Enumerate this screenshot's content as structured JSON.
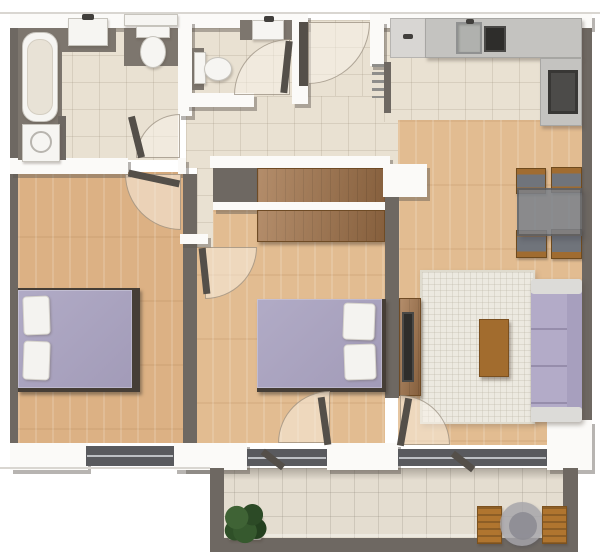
{
  "plan": {
    "kind": "apartment-floor-plan-top-view",
    "width": 600,
    "height": 560
  },
  "palette": {
    "wall_dark": "#6e6862",
    "wall_white": "#fbfaf8",
    "tile": "#e9e1d2",
    "tile_balcony": "#e4ddd0",
    "wood": "#e2bc91",
    "wood_dark": "#dcb184",
    "furniture_wood": "#a3744a",
    "lavender": "#b1abc6",
    "lavender_sofa": "#b3abc8",
    "white_fixture": "#f6f5f2",
    "counter": "#c4c3c0",
    "counter_light": "#d8d6d3",
    "appliance_dark": "#2e2d2b",
    "appliance_mid": "#4c4b49",
    "window": "#595a5e",
    "rug": "#ece9e0",
    "glass": "#7b828c",
    "plant": "#31502b",
    "chair_balcony": "#b0752f"
  },
  "rooms": [
    "bathroom",
    "wc",
    "entry-hall",
    "corridor",
    "kitchen",
    "living-dining-room",
    "bedroom-1",
    "bedroom-2",
    "balcony"
  ],
  "elements": [
    {
      "n": "top-hairline",
      "c": "hairline",
      "b": [
        0,
        12,
        600,
        2
      ]
    },
    {
      "n": "bathroom-floor",
      "c": "tile",
      "b": [
        18,
        28,
        160,
        132
      ]
    },
    {
      "n": "wc-floor",
      "c": "tile",
      "b": [
        192,
        28,
        100,
        68
      ]
    },
    {
      "n": "entry-floor",
      "c": "tile",
      "b": [
        308,
        20,
        76,
        86
      ]
    },
    {
      "n": "corridor-floor",
      "c": "tile",
      "b": [
        186,
        96,
        212,
        72
      ]
    },
    {
      "n": "kitchen-floor",
      "c": "tile",
      "b": [
        384,
        28,
        198,
        94
      ]
    },
    {
      "n": "living-room-floor",
      "c": "wood",
      "b": [
        398,
        120,
        184,
        325
      ]
    },
    {
      "n": "bedroom2-niche-floor",
      "c": "wood",
      "b": [
        213,
        164,
        172,
        46
      ]
    },
    {
      "n": "bedroom2-floor",
      "c": "wood",
      "b": [
        195,
        210,
        190,
        233
      ]
    },
    {
      "n": "corridor-stub-floor",
      "c": "tile",
      "b": [
        197,
        168,
        16,
        79
      ]
    },
    {
      "n": "bedroom1-floor",
      "c": "wood wood-dark",
      "b": [
        18,
        172,
        165,
        271
      ]
    },
    {
      "n": "balcony-floor",
      "c": "tileb",
      "b": [
        210,
        468,
        368,
        80
      ]
    },
    {
      "n": "balcony-wall-shadow",
      "c": "shade",
      "b": [
        224,
        468,
        339,
        12
      ]
    },
    {
      "n": "top-wall-left",
      "c": "wallw",
      "b": [
        10,
        14,
        298,
        14
      ]
    },
    {
      "n": "top-wall-right",
      "c": "wallw",
      "b": [
        370,
        14,
        222,
        14
      ]
    },
    {
      "n": "left-outer-wall",
      "c": "walld",
      "b": [
        10,
        28,
        8,
        415
      ]
    },
    {
      "n": "right-outer-wall",
      "c": "walld",
      "b": [
        582,
        28,
        10,
        392
      ]
    },
    {
      "n": "bathroom-right-wall",
      "c": "wallw",
      "b": [
        178,
        20,
        14,
        96
      ]
    },
    {
      "n": "bathroom-bottom-wall",
      "c": "wallw",
      "b": [
        10,
        158,
        118,
        16
      ]
    },
    {
      "n": "bathroom-bottom-wall-cap",
      "c": "wallw",
      "b": [
        178,
        158,
        8,
        16
      ]
    },
    {
      "n": "wc-bottom-wall",
      "c": "wallw",
      "b": [
        186,
        93,
        68,
        14
      ]
    },
    {
      "n": "wc-right-wall",
      "c": "wallw",
      "b": [
        292,
        20,
        16,
        84
      ]
    },
    {
      "n": "entry-right-wall",
      "c": "wallw",
      "b": [
        370,
        20,
        14,
        46
      ]
    },
    {
      "n": "kitchen-west-wall",
      "c": "walld",
      "b": [
        384,
        62,
        7,
        51
      ]
    },
    {
      "n": "wardrobe-niche-top-wall",
      "c": "wallw",
      "b": [
        210,
        156,
        180,
        12
      ]
    },
    {
      "n": "wardrobe-niche-left-block",
      "c": "walld",
      "b": [
        213,
        168,
        44,
        40
      ]
    },
    {
      "n": "hall-wardrobe",
      "c": "wood-item",
      "b": [
        257,
        168,
        130,
        36
      ]
    },
    {
      "n": "wardrobe-niche-mid-wall",
      "c": "wallw",
      "b": [
        213,
        202,
        177,
        8
      ]
    },
    {
      "n": "bedroom2-wardrobe",
      "c": "wood-item",
      "b": [
        257,
        210,
        128,
        32
      ]
    },
    {
      "n": "bedroom-divider-wall",
      "c": "walld",
      "b": [
        183,
        174,
        14,
        269
      ]
    },
    {
      "n": "bedroom-divider-cap",
      "c": "wallw",
      "b": [
        180,
        234,
        28,
        10
      ]
    },
    {
      "n": "living-wall-corner",
      "c": "wallw",
      "b": [
        383,
        164,
        44,
        33
      ]
    },
    {
      "n": "bedroom2-living-wall",
      "c": "walld",
      "b": [
        385,
        197,
        14,
        201
      ]
    },
    {
      "n": "bedroom1-bottom-wall-left",
      "c": "wallw",
      "b": [
        10,
        443,
        78,
        27
      ]
    },
    {
      "n": "bedroom1-window",
      "c": "window",
      "b": [
        86,
        446,
        88,
        20
      ]
    },
    {
      "n": "bedroom1-bottom-wall-right",
      "c": "wallw",
      "b": [
        174,
        443,
        36,
        27
      ]
    },
    {
      "n": "bedroom2-bottom-wall-left",
      "c": "wallw",
      "b": [
        183,
        443,
        64,
        27
      ]
    },
    {
      "n": "bedroom2-balcony-door-glass",
      "c": "window",
      "b": [
        247,
        449,
        80,
        17
      ]
    },
    {
      "n": "bedroom2-bottom-wall-right",
      "c": "wallw",
      "b": [
        327,
        443,
        71,
        27
      ]
    },
    {
      "n": "living-balcony-window",
      "c": "window",
      "b": [
        398,
        449,
        149,
        17
      ]
    },
    {
      "n": "living-bottom-wall",
      "c": "wallw",
      "b": [
        547,
        420,
        45,
        50
      ]
    },
    {
      "n": "left-hairline",
      "c": "hairline",
      "b": [
        0,
        467,
        210,
        2
      ]
    },
    {
      "n": "bathtub-deck",
      "c": "wallm",
      "b": [
        18,
        28,
        44,
        132
      ]
    },
    {
      "n": "bathtub",
      "c": "white-box",
      "b": [
        22,
        32,
        36,
        90
      ],
      "rad": "14px"
    },
    {
      "n": "bathtub-inner",
      "c": "inner-beige",
      "b": [
        27,
        39,
        26,
        76
      ],
      "rad": "12px"
    },
    {
      "n": "washer-nook-wall",
      "c": "walld",
      "b": [
        58,
        116,
        8,
        44
      ]
    },
    {
      "n": "washing-machine",
      "c": "white-box",
      "b": [
        22,
        124,
        38,
        38
      ]
    },
    {
      "n": "washing-machine-door",
      "c": "ring",
      "b": [
        30,
        131,
        22,
        22
      ],
      "rad": "50%"
    },
    {
      "n": "bath-sink-backsplash",
      "c": "wallm",
      "b": [
        62,
        28,
        54,
        24
      ]
    },
    {
      "n": "bath-sink",
      "c": "white-box",
      "b": [
        68,
        18,
        40,
        28
      ]
    },
    {
      "n": "bath-faucet",
      "c": "dark-dot",
      "b": [
        82,
        14,
        12,
        6
      ]
    },
    {
      "n": "bath-toilet-backdrop",
      "c": "wallm",
      "b": [
        124,
        28,
        54,
        38
      ]
    },
    {
      "n": "bath-toilet-shelf",
      "c": "white-box",
      "b": [
        124,
        14,
        54,
        12
      ]
    },
    {
      "n": "bath-toilet-cistern",
      "c": "white-box",
      "b": [
        136,
        26,
        34,
        12
      ]
    },
    {
      "n": "bath-toilet-bowl",
      "c": "white-box",
      "b": [
        140,
        36,
        26,
        32
      ],
      "rad": "50%"
    },
    {
      "n": "bathroom-door-arc",
      "c": "arc",
      "b": [
        136,
        114,
        44,
        44
      ],
      "rad": "100% 0 0 0"
    },
    {
      "n": "bathroom-door-leaf",
      "c": "leaf",
      "b": [
        133,
        116,
        7,
        42
      ],
      "r": -14
    },
    {
      "n": "wc-toilet-backdrop",
      "c": "wallm",
      "b": [
        192,
        48,
        12,
        42
      ]
    },
    {
      "n": "wc-toilet-cistern",
      "c": "white-box",
      "b": [
        194,
        52,
        12,
        32
      ]
    },
    {
      "n": "wc-toilet-bowl",
      "c": "white-box",
      "b": [
        204,
        57,
        28,
        24
      ],
      "rad": "50%"
    },
    {
      "n": "wc-sink-backsplash",
      "c": "wallm",
      "b": [
        240,
        20,
        52,
        20
      ]
    },
    {
      "n": "wc-sink",
      "c": "white-box",
      "b": [
        252,
        20,
        32,
        20
      ]
    },
    {
      "n": "wc-faucet",
      "c": "dark-dot",
      "b": [
        264,
        16,
        10,
        6
      ]
    },
    {
      "n": "wc-door-arc",
      "c": "arc",
      "b": [
        234,
        39,
        56,
        56
      ],
      "rad": "100% 0 0 0"
    },
    {
      "n": "wc-door-leaf",
      "c": "leaf",
      "b": [
        283,
        41,
        7,
        52
      ],
      "r": 6
    },
    {
      "n": "front-door-arc",
      "c": "arc",
      "b": [
        308,
        22,
        62,
        62
      ],
      "rad": "0 0 100% 0"
    },
    {
      "n": "front-door-leaf",
      "c": "leaf",
      "b": [
        299,
        22,
        9,
        64
      ]
    },
    {
      "n": "entry-coat-rack",
      "c": "rack",
      "b": [
        372,
        64,
        12,
        34
      ]
    },
    {
      "n": "kitchen-cabinet",
      "c": "counter-light",
      "b": [
        390,
        18,
        36,
        40
      ]
    },
    {
      "n": "kitchen-cabinet-handle",
      "c": "dark-dot",
      "b": [
        403,
        34,
        10,
        5
      ]
    },
    {
      "n": "kitchen-counter-top",
      "c": "counter",
      "b": [
        425,
        18,
        157,
        40
      ]
    },
    {
      "n": "kitchen-sink",
      "c": "sink-metal",
      "b": [
        456,
        22,
        26,
        32
      ]
    },
    {
      "n": "kitchen-faucet",
      "c": "dark-dot",
      "b": [
        466,
        19,
        8,
        5
      ]
    },
    {
      "n": "kitchen-cooktop",
      "c": "dark-box",
      "b": [
        484,
        26,
        22,
        26
      ]
    },
    {
      "n": "kitchen-counter-right",
      "c": "counter",
      "b": [
        540,
        58,
        42,
        68
      ]
    },
    {
      "n": "kitchen-oven",
      "c": "oven",
      "b": [
        548,
        70,
        30,
        44
      ]
    },
    {
      "n": "dining-chair-top-left",
      "c": "chair",
      "b": [
        516,
        168,
        30,
        26
      ]
    },
    {
      "n": "dining-chair-top-right",
      "c": "chair",
      "b": [
        551,
        167,
        31,
        26
      ]
    },
    {
      "n": "dining-chair-bottom-left",
      "c": "chair",
      "b": [
        516,
        230,
        31,
        28
      ]
    },
    {
      "n": "dining-chair-bottom-right",
      "c": "chair",
      "b": [
        551,
        229,
        31,
        30
      ]
    },
    {
      "n": "dining-table",
      "c": "glass",
      "b": [
        517,
        188,
        65,
        48
      ]
    },
    {
      "n": "living-rug",
      "c": "rug",
      "b": [
        420,
        270,
        115,
        154
      ]
    },
    {
      "n": "tv-unit",
      "c": "wood-item",
      "b": [
        399,
        298,
        22,
        98
      ]
    },
    {
      "n": "tv",
      "c": "dark-box",
      "b": [
        402,
        312,
        12,
        70
      ]
    },
    {
      "n": "coffee-table",
      "c": "wood-item2",
      "b": [
        479,
        319,
        30,
        58
      ]
    },
    {
      "n": "sofa-base",
      "c": "sofa-base",
      "b": [
        531,
        279,
        51,
        143
      ]
    },
    {
      "n": "sofa-seat",
      "c": "sofa-seat",
      "b": [
        531,
        293,
        38,
        114
      ]
    },
    {
      "n": "sofa-back",
      "c": "sofa-back",
      "b": [
        567,
        287,
        15,
        128
      ]
    },
    {
      "n": "sofa-armrest-top",
      "c": "sofa-arm",
      "b": [
        531,
        279,
        51,
        15
      ]
    },
    {
      "n": "sofa-armrest-bottom",
      "c": "sofa-arm",
      "b": [
        531,
        407,
        51,
        15
      ]
    },
    {
      "n": "bed1-frame",
      "c": "bedframe",
      "b": [
        18,
        288,
        122,
        104
      ]
    },
    {
      "n": "bed1-duvet",
      "c": "duvet",
      "b": [
        18,
        290,
        114,
        98
      ]
    },
    {
      "n": "bed1-pillow-top",
      "c": "pillow",
      "b": [
        23,
        296,
        27,
        39
      ],
      "r": -2
    },
    {
      "n": "bed1-pillow-bottom",
      "c": "pillow",
      "b": [
        23,
        341,
        27,
        39
      ],
      "r": 2
    },
    {
      "n": "bed2-frame",
      "c": "bedframe",
      "b": [
        257,
        299,
        129,
        93
      ]
    },
    {
      "n": "bed2-duvet",
      "c": "duvet",
      "b": [
        257,
        299,
        125,
        89
      ]
    },
    {
      "n": "bed2-pillow-top",
      "c": "pillow",
      "b": [
        343,
        303,
        32,
        37
      ],
      "r": 2
    },
    {
      "n": "bed2-pillow-bottom",
      "c": "pillow",
      "b": [
        344,
        344,
        32,
        36
      ],
      "r": -2
    },
    {
      "n": "bedroom1-door-arc",
      "c": "arc",
      "b": [
        125,
        174,
        56,
        56
      ],
      "rad": "0 0 0 100%"
    },
    {
      "n": "bedroom1-door-leaf",
      "c": "leaf",
      "b": [
        128,
        175,
        52,
        7
      ],
      "r": 12
    },
    {
      "n": "bedroom2-door-arc",
      "c": "arc",
      "b": [
        205,
        247,
        52,
        52
      ],
      "rad": "0 0 100% 0"
    },
    {
      "n": "bedroom2-door-leaf",
      "c": "leaf",
      "b": [
        201,
        248,
        7,
        46
      ],
      "r": -6
    },
    {
      "n": "bedroom2-balcony-door-arc",
      "c": "arc",
      "b": [
        278,
        391,
        52,
        52
      ],
      "rad": "100% 0 0 0"
    },
    {
      "n": "bedroom2-balcony-door-leaf",
      "c": "leaf",
      "b": [
        321,
        397,
        7,
        48
      ],
      "r": -8
    },
    {
      "n": "living-balcony-door-arc",
      "c": "arc",
      "b": [
        400,
        395,
        50,
        50
      ],
      "rad": "0 100% 0 0"
    },
    {
      "n": "living-balcony-door-leaf",
      "c": "leaf",
      "b": [
        401,
        398,
        7,
        48
      ],
      "r": 10
    },
    {
      "n": "balcony-wall-left",
      "c": "walld",
      "b": [
        210,
        468,
        14,
        80
      ]
    },
    {
      "n": "balcony-wall-right",
      "c": "walld",
      "b": [
        563,
        468,
        15,
        80
      ]
    },
    {
      "n": "balcony-railing",
      "c": "walld",
      "b": [
        210,
        538,
        368,
        14
      ]
    },
    {
      "n": "balcony-railing-highlight",
      "c": "hairline2",
      "b": [
        224,
        534,
        339,
        3
      ]
    },
    {
      "n": "bedroom2-outswing-leaf",
      "c": "leaf",
      "b": [
        260,
        456,
        26,
        7
      ],
      "r": 38
    },
    {
      "n": "living-outswing-leaf",
      "c": "leaf",
      "b": [
        450,
        458,
        26,
        7
      ],
      "r": 38
    },
    {
      "n": "balcony-plant-pot",
      "c": "pot",
      "b": [
        228,
        514,
        34,
        26
      ]
    },
    {
      "n": "balcony-plant",
      "c": "plant",
      "b": [
        222,
        500,
        46,
        46
      ]
    },
    {
      "n": "balcony-chair-left",
      "c": "bchair",
      "b": [
        477,
        506,
        25,
        38
      ]
    },
    {
      "n": "balcony-table",
      "c": "glass2",
      "b": [
        500,
        502,
        44,
        44
      ],
      "rad": "50%"
    },
    {
      "n": "balcony-table-top",
      "c": "circle-inner",
      "b": [
        509,
        512,
        28,
        28
      ],
      "rad": "50%"
    },
    {
      "n": "balcony-chair-right",
      "c": "bchair",
      "b": [
        542,
        506,
        25,
        38
      ]
    }
  ]
}
